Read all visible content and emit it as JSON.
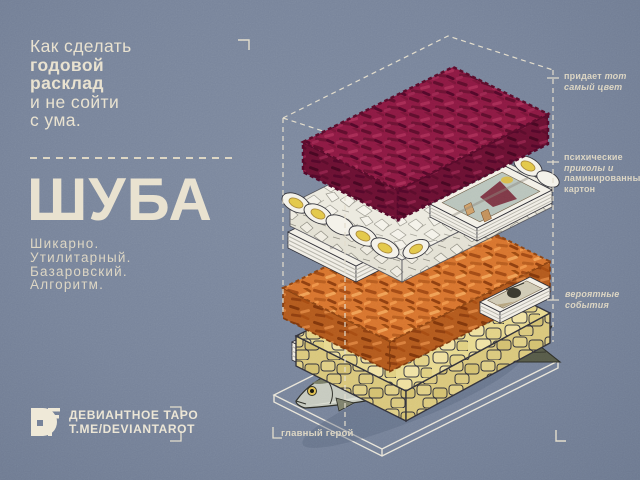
{
  "poster": {
    "headline": {
      "line1": "Как сделать",
      "line2": "годовой",
      "line3": "расклад",
      "line4": "и не сойти",
      "line5": "с ума."
    },
    "title": "ШУБА",
    "subtitle": [
      "Шикарно.",
      "Утилитарный.",
      "Базаровский.",
      "Алгоритм."
    ],
    "annotations": {
      "beet_color": {
        "w1": "придает",
        "w2": "тот",
        "l2": "самый цвет"
      },
      "cards": {
        "l1": "психические",
        "l2": "приколы и",
        "l3": "ламинированный",
        "l4": "картон"
      },
      "events": {
        "l1": "вероятные",
        "l2": "события"
      },
      "hero": {
        "label": "главный герой"
      }
    },
    "logo": {
      "name": "ДЕВИАНТНОЕ ТАРО",
      "url": "T.ME/DEVIANTAROT",
      "monogram": "DF"
    },
    "diagram": {
      "type": "exploded-isometric-stack",
      "layers": [
        "shredded-beetroot",
        "egg-slices",
        "tarot-card-decks",
        "shredded-carrot",
        "potato-cubes",
        "tarot-card-decks",
        "herring-fish",
        "plate-outline"
      ]
    }
  },
  "colors": {
    "background": "#77839a",
    "cream": "#ddd6c4",
    "beet": "#8c1a43",
    "carrot": "#d8742f",
    "potato": "#e8d98f",
    "egg_yolk": "#e3c84a",
    "card_white": "#f3f0e7",
    "fish_body": "#c6cabf",
    "ink": "#2f2f37"
  }
}
